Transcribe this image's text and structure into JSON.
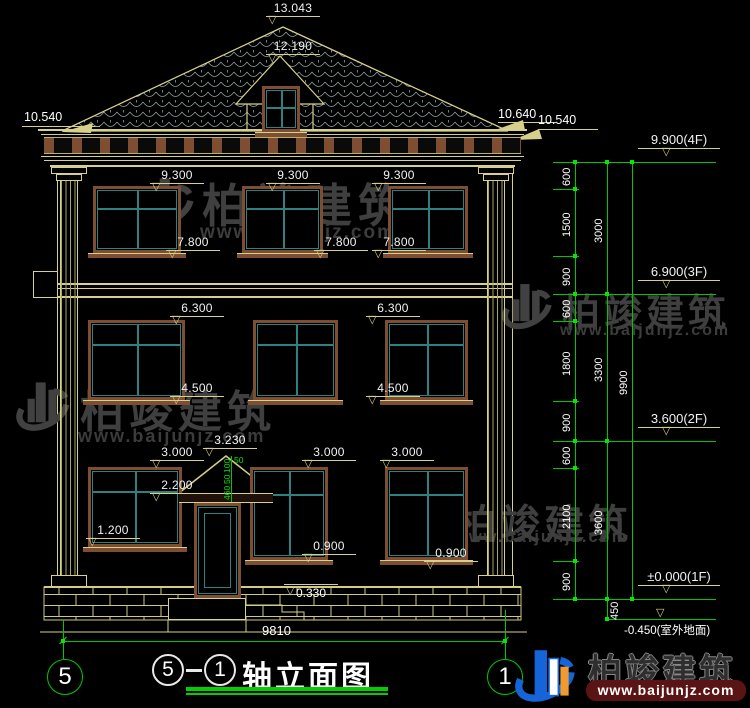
{
  "marks": {
    "apex": "13.043",
    "dormer_ridge": "12.190",
    "eave_left": "10.540",
    "eave_right_hi": "10.640",
    "eave_right_lo": "10.540",
    "f3_head": "9.300",
    "f3_sill": "7.800",
    "f2_head": "6.300",
    "f2_sill": "4.500",
    "f1_head": "3.000",
    "porch_apex": "3.230",
    "door_head": "2.200",
    "w_left_sill": "1.200",
    "f1_sill": "0.900",
    "plinth_top": "0.330"
  },
  "levels": {
    "f4": "9.900(4F)",
    "f3": "6.900(3F)",
    "f2": "3.600(2F)",
    "f1": "±0.000(1F)",
    "ground": "-0.450(室外地面)"
  },
  "chains": {
    "c1": [
      "600",
      "1500",
      "900",
      "600",
      "1800",
      "900",
      "600",
      "2100",
      "900"
    ],
    "c2": [
      "3000",
      "3300",
      "3600",
      "450"
    ],
    "c3": [
      "9900"
    ]
  },
  "door_dims": {
    "top": "50",
    "a": "100",
    "b": "50",
    "c": "460"
  },
  "base": {
    "total_width": "9810",
    "axis_left": "5",
    "axis_right": "1"
  },
  "title": {
    "axis_from": "5",
    "sep": "—",
    "axis_to": "1",
    "text": "轴立面图"
  },
  "watermark": {
    "name": "柏竣建筑",
    "url": "www.baijunjz.com"
  },
  "brand": {
    "name": "柏竣建筑",
    "url": "www.baijunjz.com"
  },
  "colors": {
    "cad_yellow": "#d6d08a",
    "cad_green": "#00c800",
    "teal_frame": "#2f8080",
    "brown_trim": "#7d4e32",
    "brand_blue": "#1565d8",
    "brand_orange": "#f09b2f"
  }
}
